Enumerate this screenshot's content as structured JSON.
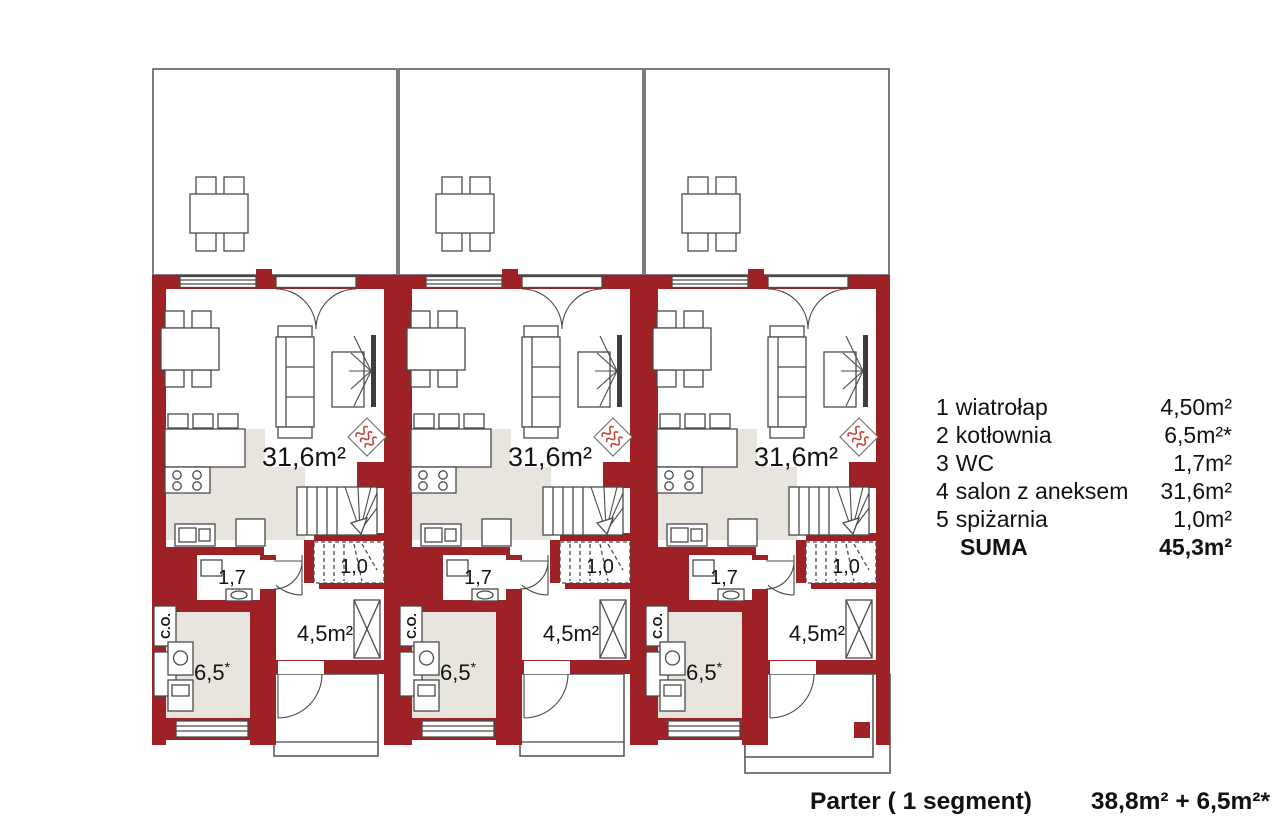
{
  "title": "Parter - rzut (3 segmenty)",
  "colors": {
    "wall": "#9d2125",
    "floor": "#e8e5de",
    "heater": "#c2453a"
  },
  "rooms": {
    "salon": "31,6m²",
    "wc": "1,7",
    "pantry": "1,0",
    "hall": "4,5m²",
    "boiler": "6,5",
    "boiler_mark": "*",
    "co": "C.O."
  },
  "legend": {
    "items": [
      {
        "num": "1",
        "name": "wiatrołap",
        "area": "4,50m²"
      },
      {
        "num": "2",
        "name": "kotłownia",
        "area": "6,5m²*"
      },
      {
        "num": "3",
        "name": "WC",
        "area": "1,7m²"
      },
      {
        "num": "4",
        "name": "salon z aneksem",
        "area": "31,6m²"
      },
      {
        "num": "5",
        "name": "spiżarnia",
        "area": "1,0m²"
      }
    ],
    "total_label": "SUMA",
    "total_area": "45,3m²"
  },
  "caption": {
    "title": "Parter ( 1 segment)",
    "area": "38,8m² + 6,5m²*"
  }
}
